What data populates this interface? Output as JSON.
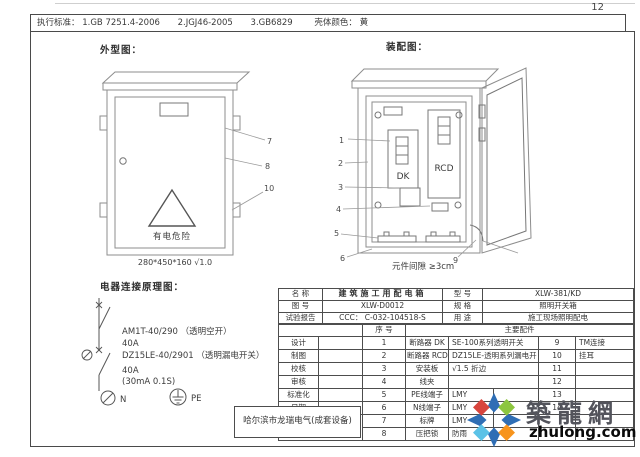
{
  "page": {
    "number": "12"
  },
  "top_bar": {
    "label": "执行标准：",
    "standards": [
      "1.GB 7251.4-2006",
      "2.JGJ46-2005",
      "3.GB6829"
    ],
    "shell_color_label": "壳体颜色：",
    "shell_color_value": "黄"
  },
  "outline": {
    "title": "外型图：",
    "warning_text": "有电危险",
    "dimensions": "280*450*160  √1.0",
    "leaders": {
      "l7": "7",
      "l8": "8",
      "l10": "10"
    }
  },
  "assembly": {
    "title": "装配图：",
    "dk_label": "DK",
    "rcd_label": "RCD",
    "clearance_note": "元件间隙 ≥3cm",
    "leaders": {
      "l1": "1",
      "l2": "2",
      "l3": "3",
      "l4": "4",
      "l5": "5",
      "l6": "6",
      "l9": "9"
    }
  },
  "schematic": {
    "title": "电器连接原理图：",
    "line1": "AM1T-40/290 （透明空开）",
    "line2": "40A",
    "line3": "DZ15LE-40/2901 （透明漏电开关）",
    "line4": "40A",
    "line5": "(30mA 0.1S)",
    "neutral_label": "N",
    "earth_label": "PE"
  },
  "title_block": {
    "name_label": "名    称",
    "name_value": "建筑施工用配电箱",
    "model_label": "型    号",
    "model_value": "XLW-381/KD",
    "drawing_no_label": "图    号",
    "drawing_no_value": "XLW-D0012",
    "spec_label": "规    格",
    "spec_value": "照明开关箱",
    "report_label": "试验报告",
    "report_value": "CCC： C-032-104518-S",
    "use_label": "用    途",
    "use_value": "施工现场照明配电",
    "seq_header": "序    号",
    "parts_header": "主要配件",
    "rows": [
      {
        "label": "设计",
        "seq": "1",
        "part": "断路器 DK",
        "spec": "SE-100系列透明开关",
        "num": "9",
        "note": "TM连接"
      },
      {
        "label": "制图",
        "seq": "2",
        "part": "断路器 RCD",
        "spec": "DZ15LE-透明系列漏电开",
        "num": "10",
        "note": "挂耳"
      },
      {
        "label": "校核",
        "seq": "3",
        "part": "安装板",
        "spec": "√1.5 折边",
        "num": "11",
        "note": ""
      },
      {
        "label": "审核",
        "seq": "4",
        "part": "线夹",
        "spec": "",
        "num": "12",
        "note": ""
      },
      {
        "label": "标准化",
        "seq": "5",
        "part": "PE线端子",
        "spec": "LMY",
        "num": "13",
        "note": ""
      },
      {
        "label": "日期",
        "seq": "6",
        "part": "N线端子",
        "spec": "LMY",
        "num": "14",
        "note": ""
      },
      {
        "seq": "7",
        "part": "标牌",
        "spec": "LMY",
        "num": "",
        "note": ""
      },
      {
        "seq": "8",
        "part": "压把锁",
        "spec": "防雨",
        "num": "",
        "note": ""
      }
    ]
  },
  "company": {
    "name": "哈尔滨市龙瑞电气(成套设备)"
  },
  "logo": {
    "name": "築龍網",
    "domain": "zhulong.com",
    "colors": {
      "cross": "#2f6eb5",
      "nw": "#d8453e",
      "ne": "#8dc63f",
      "sw": "#5bc2e7",
      "se": "#f7941d"
    }
  }
}
